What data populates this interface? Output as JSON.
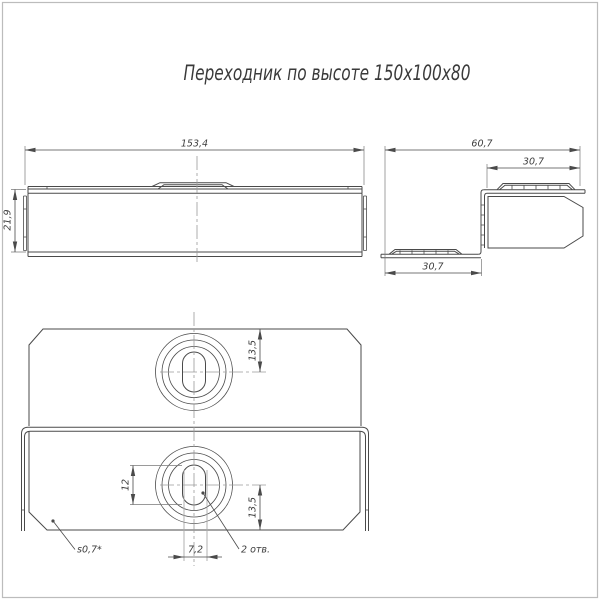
{
  "title": "Переходник по высоте 150х100х80",
  "views": {
    "front": {
      "width_dim": "153,4",
      "height_dim": "21,9"
    },
    "side": {
      "total_width_dim": "60,7",
      "upper_flange_dim": "30,7",
      "lower_flange_dim": "30,7"
    },
    "plan": {
      "upper_hole_offset_dim": "13,5",
      "slot_length_dim": "12",
      "lower_hole_offset_dim": "13,5",
      "slot_width_dim": "7,2",
      "holes_note": "2 отв.",
      "thickness_note": "s0,7*"
    }
  },
  "colors": {
    "line": "#4a4a4a",
    "centerline": "#9a9a9a",
    "frame": "#bcbcbc",
    "background": "#ffffff"
  }
}
